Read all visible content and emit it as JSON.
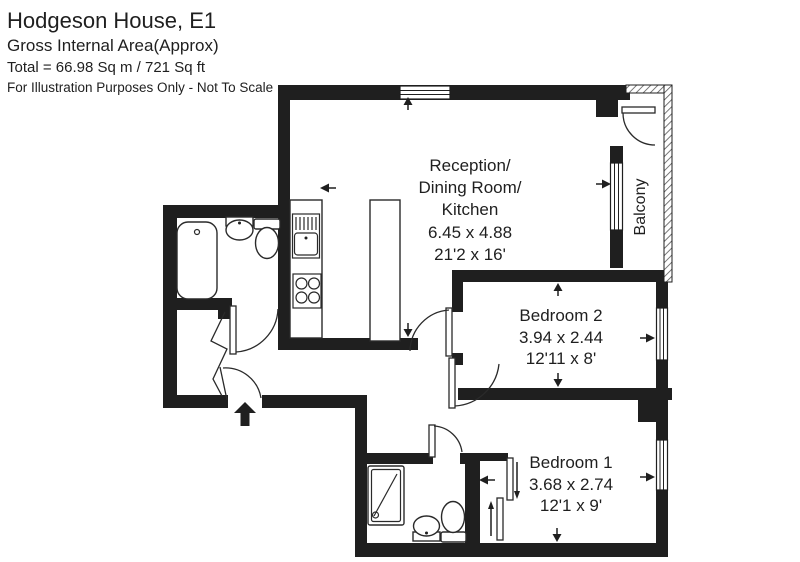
{
  "header": {
    "title": "Hodgeson House, E1",
    "subtitle": "Gross Internal Area(Approx)",
    "total": "Total = 66.98 Sq m / 721 Sq ft",
    "disclaimer": "For Illustration Purposes Only - Not To Scale"
  },
  "rooms": {
    "reception": {
      "line1": "Reception/",
      "line2": "Dining Room/",
      "line3": "Kitchen",
      "metric": "6.45 x 4.88",
      "imperial": "21'2 x 16'"
    },
    "bedroom2": {
      "name": "Bedroom 2",
      "metric": "3.94 x 2.44",
      "imperial": "12'11 x 8'"
    },
    "bedroom1": {
      "name": "Bedroom 1",
      "metric": "3.68 x 2.74",
      "imperial": "12'1 x 9'"
    },
    "balcony": {
      "name": "Balcony"
    }
  },
  "colors": {
    "wall": "#1f1f1f",
    "background": "#ffffff",
    "fixture_line": "#2a2a2a"
  }
}
